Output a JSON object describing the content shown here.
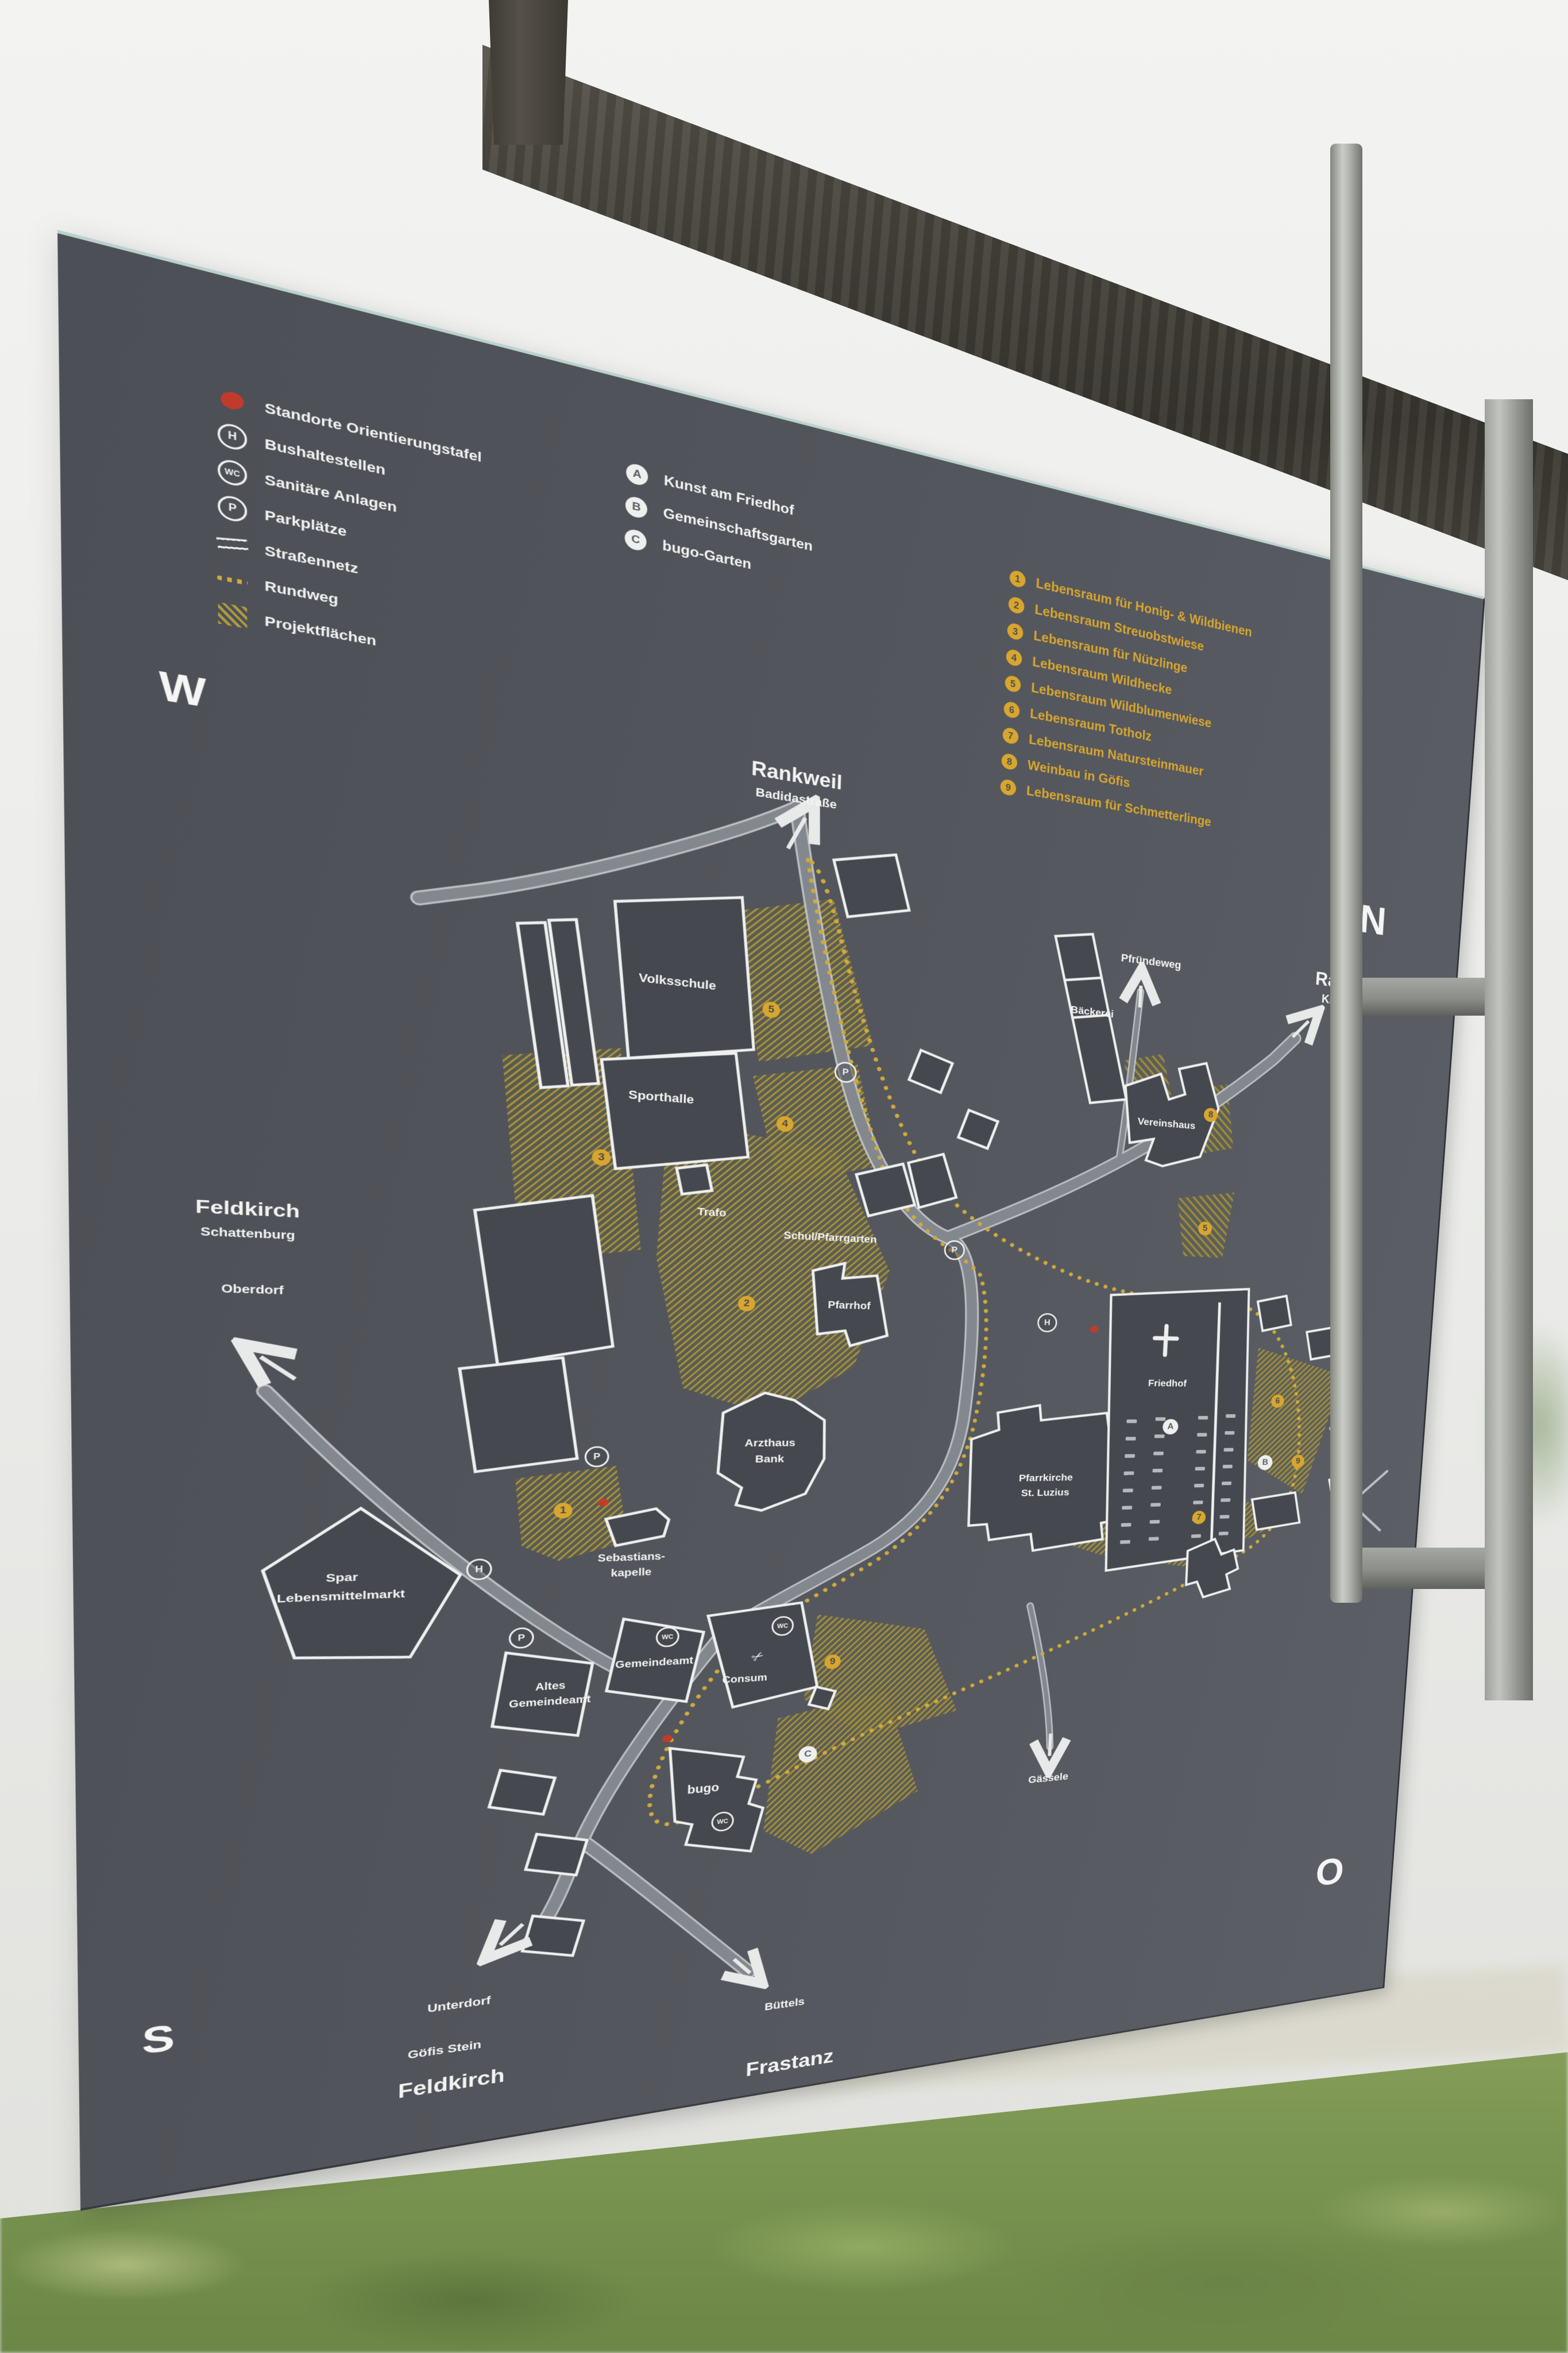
{
  "colors": {
    "panel": "#53565c",
    "accent_gold": "#d8a62e",
    "hatch_gold": "#a8943a",
    "marker_red": "#c13b2a",
    "road_gray": "#83888e",
    "text_white": "#f2f3f2"
  },
  "sign": {
    "legend": {
      "items": [
        {
          "icon": "location-dot-icon",
          "label": "Standorte Orientierungstafel"
        },
        {
          "icon": "bus-stop-icon",
          "badge": "H",
          "label": "Bushaltestellen"
        },
        {
          "icon": "wc-icon",
          "badge": "WC",
          "label": "Sanitäre Anlagen"
        },
        {
          "icon": "parking-icon",
          "badge": "P",
          "label": "Parkplätze"
        },
        {
          "icon": "road-icon",
          "label": "Straßennetz"
        },
        {
          "icon": "dotted-path-icon",
          "label": "Rundweg"
        },
        {
          "icon": "hatch-icon",
          "label": "Projektflächen"
        }
      ]
    },
    "poi_legend": [
      {
        "badge": "A",
        "label": "Kunst am Friedhof"
      },
      {
        "badge": "B",
        "label": "Gemeinschaftsgarten"
      },
      {
        "badge": "C",
        "label": "bugo-Garten"
      }
    ],
    "project_list": [
      {
        "num": "1",
        "label": "Lebensraum für Honig- & Wildbienen"
      },
      {
        "num": "2",
        "label": "Lebensraum Streuobstwiese"
      },
      {
        "num": "3",
        "label": "Lebensraum für Nützlinge"
      },
      {
        "num": "4",
        "label": "Lebensraum Wildhecke"
      },
      {
        "num": "5",
        "label": "Lebensraum Wildblumenwiese"
      },
      {
        "num": "6",
        "label": "Lebensraum Totholz"
      },
      {
        "num": "7",
        "label": "Lebensraum Natursteinmauer"
      },
      {
        "num": "8",
        "label": "Weinbau in Göfis"
      },
      {
        "num": "9",
        "label": "Lebensraum für Schmetterlinge"
      }
    ],
    "compass": {
      "west": "W",
      "north": "N",
      "south": "S",
      "east": "O"
    },
    "destinations": {
      "north_title": "Rankweil",
      "north_sub": "Badidastraße",
      "northeast_title": "Rankweil",
      "northeast_sub": "Kirchstraße",
      "west_title": "Feldkirch",
      "west_sub": "Schattenburg",
      "west_sub2": "Oberdorf",
      "pfruendeweg": "Pfründeweg",
      "gaessele": "Gässele",
      "south_left_sub": "Unterdorf",
      "south_left_sub2": "Göfis Stein",
      "south_left_title": "Feldkirch",
      "south_right_sub": "Büttels",
      "south_right_title": "Frastanz"
    },
    "places": {
      "volksschule": "Volksschule",
      "sporthalle": "Sporthalle",
      "trafo": "Trafo",
      "schul_pfarrgarten": "Schul/Pfarrgarten",
      "pfarrhof": "Pfarrhof",
      "arzthaus_line1": "Arzthaus",
      "arzthaus_line2": "Bank",
      "kapelle_line1": "Sebastians-",
      "kapelle_line2": "kapelle",
      "spar_line1": "Spar",
      "spar_line2": "Lebensmittelmarkt",
      "gemeindeamt": "Gemeindeamt",
      "consum": "Consum",
      "altes_line1": "Altes",
      "altes_line2": "Gemeindeamt",
      "bugo": "bugo",
      "kirche_line1": "Pfarrkirche",
      "kirche_line2": "St. Luzius",
      "friedhof": "Friedhof",
      "baeckerei": "Bäckerei",
      "vereinshaus": "Vereinshaus"
    },
    "markers": {
      "area_numbers": [
        "1",
        "2",
        "3",
        "4",
        "5",
        "5",
        "6",
        "7",
        "8",
        "9",
        "9"
      ],
      "letters": [
        "A",
        "B",
        "C"
      ],
      "bus": "H",
      "wc": "WC",
      "parking": "P",
      "scissors_icon": "✂"
    }
  }
}
